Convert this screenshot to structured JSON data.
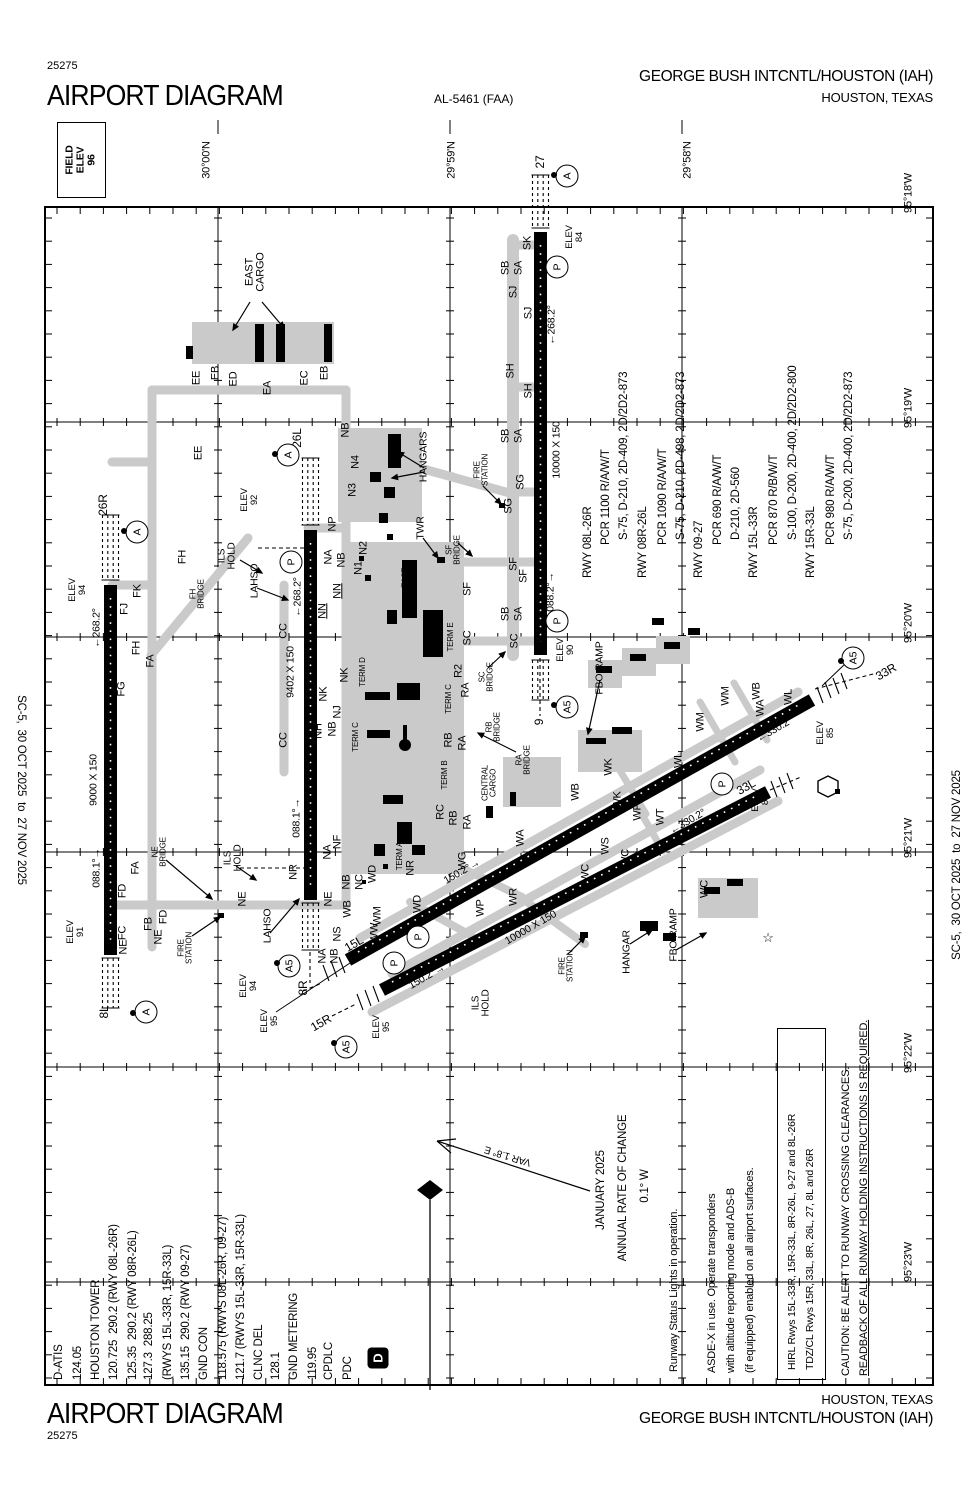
{
  "header": {
    "chart_number": "25275",
    "title": "AIRPORT DIAGRAM",
    "al_number": "AL-5461 (FAA)",
    "airport_name": "GEORGE BUSH INTCNTL/HOUSTON (IAH)",
    "city": "HOUSTON, TEXAS"
  },
  "footer": {
    "title": "AIRPORT DIAGRAM",
    "chart_number": "25275",
    "city": "HOUSTON, TEXAS",
    "airport_name": "GEORGE BUSH INTCNTL/HOUSTON (IAH)"
  },
  "edges": {
    "left": "SC-5,  30 OCT 2025  to  27 NOV 2025",
    "right": "SC-5,  30 OCT 2025  to  27 NOV 2025"
  },
  "field_elev": "FIELD\nELEV\n96",
  "grid": {
    "lat_labels": [
      {
        "t": "30°00'N",
        "x": 207,
        "y": 160
      },
      {
        "t": "29°59'N",
        "x": 452,
        "y": 160
      },
      {
        "t": "29°58'N",
        "x": 688,
        "y": 160
      }
    ],
    "lon_labels": [
      {
        "t": "95°18'W",
        "x": 909,
        "y": 193
      },
      {
        "t": "95°19'W",
        "x": 909,
        "y": 408
      },
      {
        "t": "95°20'W",
        "x": 909,
        "y": 623
      },
      {
        "t": "95°21'W",
        "x": 909,
        "y": 838
      },
      {
        "t": "95°22'W",
        "x": 909,
        "y": 1053
      },
      {
        "t": "95°23'W",
        "x": 909,
        "y": 1262
      }
    ]
  },
  "comm_block": {
    "anchor_y": 1380,
    "lines": [
      [
        "D-ATIS",
        53
      ],
      [
        "124.05",
        72
      ],
      [
        "HOUSTON TOWER",
        90
      ],
      [
        "120.725  290.2 (RWY 08L-26R)",
        108
      ],
      [
        "125.35  290.2 (RWY 08R-26L)",
        127
      ],
      [
        "127.3  288.25",
        143
      ],
      [
        "(RWYS 15L-33R, 15R-33L)",
        162
      ],
      [
        "135.15  290.2 (RWY 09-27)",
        180
      ],
      [
        "GND CON",
        198
      ],
      [
        "118.575 (RWYS 08L-26R, 09-27)",
        217
      ],
      [
        "121.7 (RWYS 15L-33R, 15R-33L)",
        235
      ],
      [
        "CLNC DEL",
        253
      ],
      [
        "128.1",
        270
      ],
      [
        "GND METERING",
        288
      ],
      [
        "119.95",
        307
      ],
      [
        "CPDLC",
        323
      ],
      [
        "PDC",
        342
      ]
    ],
    "datalink_symbol": "D"
  },
  "runway_data_block": {
    "lines": [
      [
        "RWY 08L-26R",
        582,
        578
      ],
      [
        "PCR 1100 R/A/W/T",
        600,
        545
      ],
      [
        "S-75, D-210, 2D-409, 2D/2D2-873",
        618,
        540
      ],
      [
        "RWY 08R-26L",
        637,
        578
      ],
      [
        "PCR 1090 R/A/W/T",
        657,
        545
      ],
      [
        "S-75, D-210, 2D-498, 2D/2D2-873",
        675,
        540
      ],
      [
        "RWY 09-27",
        693,
        578
      ],
      [
        "PCR 690 R/A/W/T",
        712,
        545
      ],
      [
        "D-210, 2D-560",
        730,
        540
      ],
      [
        "RWY 15L-33R",
        748,
        578
      ],
      [
        "PCR 870 R/B/W/T",
        768,
        545
      ],
      [
        "S-100, D-200, 2D-400, 2D/2D2-800",
        787,
        540
      ],
      [
        "RWY 15R-33L",
        805,
        578
      ],
      [
        "PCR 980 R/A/W/T",
        825,
        545
      ],
      [
        "S-75, D-200, 2D-400, 2D/2D2-873",
        843,
        540
      ]
    ]
  },
  "notes": {
    "rsl": {
      "t": "Runway Status Lights in operation.",
      "x": 668,
      "y": 1372
    },
    "asdex": [
      [
        "ASDE-X in use. Operate transponders",
        706,
        1373
      ],
      [
        "with altitude reporting mode and ADS-B",
        725,
        1373
      ],
      [
        "(if equipped) enabled on all airport surfaces.",
        744,
        1373
      ]
    ],
    "hirl": [
      [
        "HIRL Rwys 15L-33R, 15R-33L, 8R-26L, 9-27 and 8L-26R",
        786,
        1370
      ],
      [
        "TDZ/CL Rwys 15R, 33L, 8R, 26L, 27, 8L and 26R",
        804,
        1370
      ]
    ],
    "caution": [
      {
        "t": "CAUTION: BE ALERT TO RUNWAY CROSSING CLEARANCES.",
        "x": 840,
        "y": 1376,
        "u": false
      },
      {
        "t": "READBACK OF ALL RUNWAY HOLDING INSTRUCTIONS IS REQUIRED.",
        "x": 858,
        "y": 1376,
        "u": true
      }
    ],
    "annual_rate": [
      {
        "t": "JANUARY 2025",
        "x": 602,
        "y": 1190
      },
      {
        "t": "ANNUAL RATE OF CHANGE",
        "x": 624,
        "y": 1188
      },
      {
        "t": "0.1° W",
        "x": 646,
        "y": 1186
      }
    ],
    "var_label": {
      "t": "VAR 1.8° E",
      "x": 508,
      "y": 1155,
      "r": 197
    }
  },
  "map_labels": [
    [
      "EAST\nCARGO",
      256,
      272,
      -90,
      11
    ],
    [
      "EE",
      197,
      378,
      -90,
      11
    ],
    [
      "EB",
      216,
      373,
      -90,
      11
    ],
    [
      "ED",
      234,
      379,
      -90,
      11
    ],
    [
      "EA",
      268,
      388,
      -90,
      11
    ],
    [
      "EC",
      305,
      378,
      -90,
      11
    ],
    [
      "EB",
      325,
      373,
      -90,
      11
    ],
    [
      "EE",
      199,
      453,
      -90,
      11
    ],
    [
      "26R",
      103,
      505,
      -90,
      12
    ],
    [
      "ELEV\n94",
      78,
      590,
      -90,
      9.5
    ],
    [
      "←268.2°",
      97,
      628,
      -90,
      10.5
    ],
    [
      "9000 X 150",
      94,
      780,
      -90,
      10.5
    ],
    [
      "088.1°→",
      97,
      868,
      -90,
      10.5
    ],
    [
      "ELEV\n91",
      76,
      932,
      -90,
      9.5
    ],
    [
      "8L",
      104,
      1012,
      -90,
      12
    ],
    [
      "FK",
      138,
      591,
      -90,
      11
    ],
    [
      "FJ",
      125,
      609,
      -90,
      11
    ],
    [
      "FH",
      183,
      557,
      -90,
      11
    ],
    [
      "FH\nBRIDGE",
      198,
      594,
      -90,
      8
    ],
    [
      "FH",
      137,
      648,
      -90,
      11
    ],
    [
      "FA",
      151,
      661,
      -90,
      11
    ],
    [
      "FG",
      122,
      689,
      -90,
      11
    ],
    [
      "FA",
      136,
      868,
      -90,
      11
    ],
    [
      "NE\nBRIDGE",
      160,
      852,
      -90,
      8
    ],
    [
      "FD",
      123,
      891,
      -90,
      11
    ],
    [
      "FD",
      164,
      917,
      -90,
      11
    ],
    [
      "FB",
      149,
      924,
      -90,
      11
    ],
    [
      "FC",
      123,
      933,
      -90,
      11
    ],
    [
      "NE",
      124,
      947,
      -90,
      11
    ],
    [
      "NE",
      159,
      937,
      -90,
      11
    ],
    [
      "FIRE\nSTATION",
      186,
      948,
      -90,
      8
    ],
    [
      "26L",
      297,
      438,
      -90,
      12
    ],
    [
      "ELEV\n92",
      250,
      500,
      -90,
      9.5
    ],
    [
      "NP",
      333,
      524,
      -90,
      11
    ],
    [
      "ILS\nHOLD",
      228,
      556,
      -90,
      10
    ],
    [
      "LAHSO",
      255,
      581,
      -90,
      10.5
    ],
    [
      "←268.2°",
      298,
      597,
      -90,
      10.5
    ],
    [
      "9402 X 150",
      291,
      672,
      -90,
      10.5
    ],
    [
      "CC",
      284,
      631,
      -90,
      11
    ],
    [
      "CC",
      284,
      740,
      -90,
      11
    ],
    [
      "NK",
      345,
      675,
      -90,
      11
    ],
    [
      "NK",
      324,
      694,
      -90,
      11
    ],
    [
      "NJ",
      338,
      712,
      -90,
      11
    ],
    [
      "NH",
      319,
      731,
      -90,
      11
    ],
    [
      "NB",
      333,
      729,
      -90,
      11
    ],
    [
      "088.1°→",
      297,
      818,
      -90,
      10.5
    ],
    [
      "ILS\nHOLD",
      234,
      858,
      -90,
      10
    ],
    [
      "NR",
      294,
      872,
      -90,
      11
    ],
    [
      "NE",
      243,
      899,
      -90,
      11
    ],
    [
      "LAHSO",
      268,
      926,
      -90,
      10.5
    ],
    [
      "ELEV\n94",
      249,
      986,
      -90,
      9.5
    ],
    [
      "8R",
      303,
      988,
      -90,
      12
    ],
    [
      "ELEV\n95",
      270,
      1021,
      -90,
      9.5
    ],
    [
      "15R",
      321,
      1023,
      -30,
      12
    ],
    [
      "ELEV\n95",
      382,
      1027,
      -90,
      9.5
    ],
    [
      "15L",
      354,
      944,
      -30,
      12
    ],
    [
      "NB",
      346,
      430,
      -90,
      11
    ],
    [
      "N4",
      356,
      462,
      -90,
      11
    ],
    [
      "N3",
      353,
      490,
      -90,
      11
    ],
    [
      "HANGARS",
      424,
      457,
      -90,
      10.5
    ],
    [
      "N2",
      364,
      548,
      -90,
      11
    ],
    [
      "N1",
      359,
      568,
      -90,
      11
    ],
    [
      "NA",
      329,
      557,
      -90,
      11
    ],
    [
      "NB",
      342,
      560,
      -90,
      11
    ],
    [
      "NN",
      338,
      591,
      -90,
      11,
      1
    ],
    [
      "NN",
      323,
      611,
      -90,
      11,
      1
    ],
    [
      "TWR",
      421,
      528,
      -90,
      10.5
    ],
    [
      "EAST\nBRIDGE",
      410,
      578,
      -90,
      8
    ],
    [
      "TERM D",
      363,
      672,
      -90,
      8
    ],
    [
      "TERM C",
      356,
      737,
      -90,
      8
    ],
    [
      "TERM C",
      449,
      699,
      -90,
      8
    ],
    [
      "TERM E",
      451,
      637,
      -90,
      8
    ],
    [
      "TERM B",
      445,
      775,
      -90,
      8
    ],
    [
      "TERM A",
      400,
      856,
      -90,
      8
    ],
    [
      "NR",
      411,
      868,
      -90,
      11
    ],
    [
      "27",
      540,
      162,
      -90,
      12
    ],
    [
      "ELEV\n84",
      575,
      237,
      -90,
      9.5
    ],
    [
      "SK",
      528,
      243,
      -90,
      11
    ],
    [
      "SB",
      506,
      268,
      -90,
      11
    ],
    [
      "SA",
      519,
      268,
      -90,
      11
    ],
    [
      "SJ",
      514,
      292,
      -90,
      11
    ],
    [
      "SJ",
      529,
      313,
      -90,
      11
    ],
    [
      "←268.2°",
      552,
      325,
      -90,
      10.5
    ],
    [
      "SH",
      511,
      371,
      -90,
      11
    ],
    [
      "SH",
      529,
      391,
      -90,
      11
    ],
    [
      "10000 X 150",
      557,
      450,
      -90,
      10.5
    ],
    [
      "SB",
      506,
      436,
      -90,
      11
    ],
    [
      "SA",
      519,
      436,
      -90,
      11
    ],
    [
      "FIRE\nSTATION",
      482,
      470,
      -90,
      8
    ],
    [
      "SG",
      521,
      482,
      -90,
      11
    ],
    [
      "SG",
      509,
      506,
      -90,
      11
    ],
    [
      "SF\nBRIDGE",
      454,
      550,
      -90,
      8
    ],
    [
      "SF",
      514,
      564,
      -90,
      11
    ],
    [
      "SF",
      524,
      576,
      -90,
      11
    ],
    [
      "SF",
      468,
      589,
      -90,
      11
    ],
    [
      "SB",
      506,
      614,
      -90,
      11
    ],
    [
      "SA",
      519,
      614,
      -90,
      11
    ],
    [
      "088.2°→",
      551,
      592,
      -90,
      10.5
    ],
    [
      "ELEV\n90",
      566,
      650,
      -90,
      9.5
    ],
    [
      "SC",
      468,
      638,
      -90,
      11
    ],
    [
      "SC",
      515,
      641,
      -90,
      11
    ],
    [
      "SC\nBRIDGE",
      487,
      677,
      -90,
      8
    ],
    [
      "R2",
      459,
      671,
      -90,
      11
    ],
    [
      "RA",
      466,
      690,
      -90,
      11
    ],
    [
      "RB\nBRIDGE",
      494,
      727,
      -90,
      8
    ],
    [
      "RB",
      449,
      740,
      -90,
      11
    ],
    [
      "RA",
      463,
      743,
      -90,
      11
    ],
    [
      "RA\nBRIDGE",
      524,
      760,
      -90,
      8
    ],
    [
      "CENTRAL\nCARGO",
      490,
      783,
      -90,
      8
    ],
    [
      "RC",
      441,
      812,
      -90,
      11
    ],
    [
      "RB",
      454,
      818,
      -90,
      11
    ],
    [
      "RA",
      468,
      822,
      -90,
      11
    ],
    [
      "9",
      539,
      722,
      -90,
      12
    ],
    [
      "FBO RAMP",
      600,
      668,
      -90,
      10.5
    ],
    [
      "12001 X 150",
      560,
      845,
      -30,
      10.5
    ],
    [
      "150.2°→",
      462,
      872,
      -30,
      10.5
    ],
    [
      "←330.2°",
      775,
      730,
      -30,
      10.5
    ],
    [
      "ELEV\n85",
      826,
      733,
      -90,
      9.5
    ],
    [
      "33R",
      886,
      672,
      -30,
      12
    ],
    [
      "10000 X 150",
      531,
      928,
      -30,
      10.5
    ],
    [
      "150.2°→",
      427,
      977,
      -30,
      10.5
    ],
    [
      "←330.2°",
      688,
      822,
      -30,
      10.5
    ],
    [
      "ELEV\n87",
      761,
      800,
      -90,
      9.5
    ],
    [
      "33L",
      746,
      787,
      -30,
      12
    ],
    [
      "ILS\nHOLD",
      482,
      1003,
      -90,
      10
    ],
    [
      "FIRE\nSTATION",
      567,
      966,
      -90,
      8
    ],
    [
      "HANGAR",
      627,
      952,
      -90,
      10.5
    ],
    [
      "FBO RAMP",
      674,
      935,
      -90,
      10.5
    ],
    [
      "WD",
      373,
      874,
      -90,
      11
    ],
    [
      "WD",
      418,
      904,
      -90,
      11
    ],
    [
      "WB",
      348,
      909,
      -90,
      11
    ],
    [
      "WM",
      378,
      916,
      -90,
      11
    ],
    [
      "WW",
      375,
      933,
      -90,
      11
    ],
    [
      "NS",
      338,
      934,
      -90,
      11
    ],
    [
      "NA",
      323,
      956,
      -90,
      11
    ],
    [
      "NB",
      335,
      956,
      -90,
      11
    ],
    [
      "NC",
      360,
      882,
      -90,
      11
    ],
    [
      "NB",
      347,
      882,
      -90,
      11
    ],
    [
      "NF",
      338,
      842,
      -90,
      11
    ],
    [
      "NA",
      328,
      852,
      -90,
      11
    ],
    [
      "NE",
      329,
      899,
      -90,
      11
    ],
    [
      "WG",
      463,
      861,
      -90,
      11
    ],
    [
      "WA",
      521,
      838,
      -90,
      11
    ],
    [
      "WB",
      576,
      792,
      -90,
      11
    ],
    [
      "WR",
      514,
      897,
      -90,
      11
    ],
    [
      "WP",
      481,
      908,
      -90,
      11
    ],
    [
      "WK",
      609,
      767,
      -90,
      11
    ],
    [
      "WK",
      618,
      800,
      -90,
      11
    ],
    [
      "WB",
      757,
      691,
      -90,
      11
    ],
    [
      "WA",
      761,
      708,
      -90,
      11
    ],
    [
      "WM",
      726,
      696,
      -90,
      11
    ],
    [
      "WM",
      701,
      722,
      -90,
      11
    ],
    [
      "WL",
      789,
      697,
      -90,
      11
    ],
    [
      "WL",
      679,
      760,
      -90,
      11
    ],
    [
      "WP",
      638,
      812,
      -90,
      11
    ],
    [
      "WT",
      661,
      817,
      -90,
      11
    ],
    [
      "WS",
      606,
      846,
      -90,
      11
    ],
    [
      "WC",
      626,
      858,
      -90,
      11
    ],
    [
      "WC",
      586,
      873,
      -90,
      11
    ],
    [
      "WC",
      705,
      889,
      -90,
      11
    ],
    [
      "☆",
      768,
      938,
      0,
      13
    ]
  ],
  "badges": [
    {
      "t": "A",
      "x": 137,
      "y": 532,
      "dx": -13,
      "dy": -1
    },
    {
      "t": "A",
      "x": 288,
      "y": 455,
      "dx": -13,
      "dy": -1
    },
    {
      "t": "A",
      "x": 567,
      "y": 176,
      "dx": -13,
      "dy": -1
    },
    {
      "t": "A",
      "x": 146,
      "y": 1012,
      "dx": -13,
      "dy": 1
    },
    {
      "t": "P",
      "x": 291,
      "y": 562
    },
    {
      "t": "P",
      "x": 557,
      "y": 267
    },
    {
      "t": "P",
      "x": 557,
      "y": 621
    },
    {
      "t": "P",
      "x": 418,
      "y": 937
    },
    {
      "t": "P",
      "x": 394,
      "y": 963
    },
    {
      "t": "P",
      "x": 722,
      "y": 784
    },
    {
      "t": "A5",
      "x": 853,
      "y": 658,
      "dx": -12,
      "dy": 3
    },
    {
      "t": "A5",
      "x": 567,
      "y": 707,
      "dx": -13,
      "dy": -2
    },
    {
      "t": "A5",
      "x": 289,
      "y": 966,
      "dx": -12,
      "dy": -3
    },
    {
      "t": "A5",
      "x": 346,
      "y": 1047,
      "dx": -12,
      "dy": -4
    }
  ]
}
